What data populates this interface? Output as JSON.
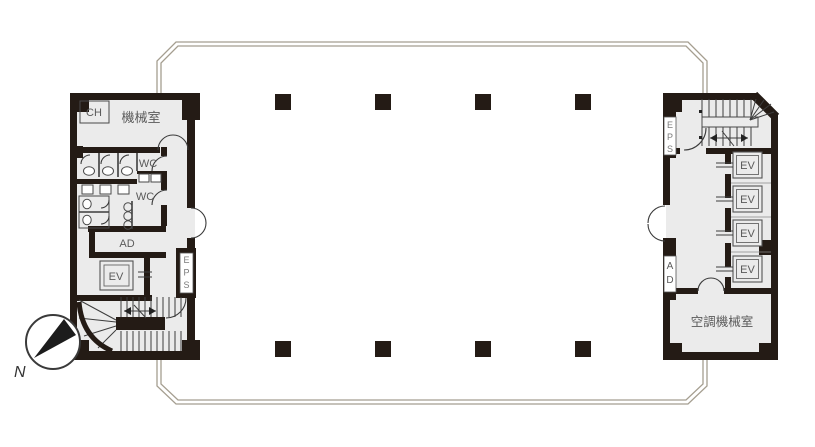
{
  "colors": {
    "office_fill": "#fdf8e3",
    "core_fill": "#ebebeb",
    "wall": "#241b15",
    "border_line": "#a59e90",
    "line": "#3d3d3d",
    "label": "#5a5a5a"
  },
  "compass": {
    "north_label": "N"
  },
  "left_core": {
    "ch_label": "CH",
    "machine_room_label": "機械室",
    "wc_upper_label": "WC",
    "wc_lower_label": "WC",
    "ad_label": "AD",
    "ev_label": "EV",
    "eps_label": "EPS"
  },
  "right_core": {
    "eps_label": "EPS",
    "ad_label": "AD",
    "ev_labels": [
      "EV",
      "EV",
      "EV",
      "EV"
    ],
    "ac_machine_room_label": "空調機械室"
  }
}
